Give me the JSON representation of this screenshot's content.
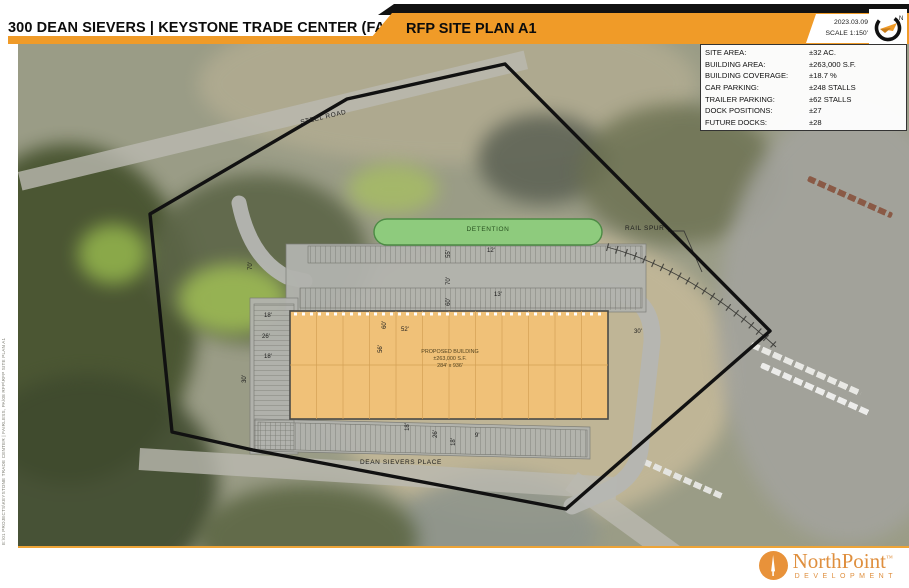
{
  "header": {
    "title": "300 DEAN SIEVERS | KEYSTONE TRADE CENTER (FAIRLESS, PA)",
    "banner": "RFP SITE PLAN A1",
    "date": "2023.03.09",
    "scale": "SCALE 1:150'",
    "north_letter": "N"
  },
  "site_table": {
    "rows": [
      {
        "label": "SITE AREA:",
        "value": "±32 AC."
      },
      {
        "label": "BUILDING AREA:",
        "value": "±263,000 S.F."
      },
      {
        "label": "BUILDING COVERAGE:",
        "value": "±18.7 %"
      },
      {
        "label": "CAR PARKING:",
        "value": "±248 STALLS"
      },
      {
        "label": "TRAILER PARKING:",
        "value": "±62 STALLS"
      },
      {
        "label": "DOCK POSITIONS:",
        "value": "±27"
      },
      {
        "label": "FUTURE DOCKS:",
        "value": "±28"
      }
    ]
  },
  "map": {
    "labels": {
      "steel_road": "STEEL ROAD",
      "dean_sievers": "DEAN SIEVERS PLACE",
      "rail_spur": "RAIL SPUR",
      "detention": "DETENTION"
    },
    "building": {
      "line1": "PROPOSED BUILDING",
      "line2": "±263,000 S.F.",
      "line3": "284' x 936'"
    },
    "dimensions": [
      {
        "text": "70'"
      },
      {
        "text": "55'"
      },
      {
        "text": "12'"
      },
      {
        "text": "70'"
      },
      {
        "text": "60'"
      },
      {
        "text": "13'"
      },
      {
        "text": "18'"
      },
      {
        "text": "26'"
      },
      {
        "text": "18'"
      },
      {
        "text": "30'"
      },
      {
        "text": "60'"
      },
      {
        "text": "52'"
      },
      {
        "text": "56'"
      },
      {
        "text": "30'"
      },
      {
        "text": "18'"
      },
      {
        "text": "26'"
      },
      {
        "text": "18'"
      },
      {
        "text": "9'"
      }
    ],
    "colors": {
      "banner_orange": "#f09b28",
      "building_fill": "#f0c178",
      "detention_green": "#8ecb7d",
      "boundary_black": "#111111"
    }
  },
  "side_note": "E:\\01 PROJECTS\\KEYSTONE TRADE CENTER | FAIRLESS, PA\\08 RFP\\RFP SITE PLAN A1",
  "footer": {
    "brand": "NorthPoint",
    "tm": "™",
    "sub": "DEVELOPMENT"
  }
}
